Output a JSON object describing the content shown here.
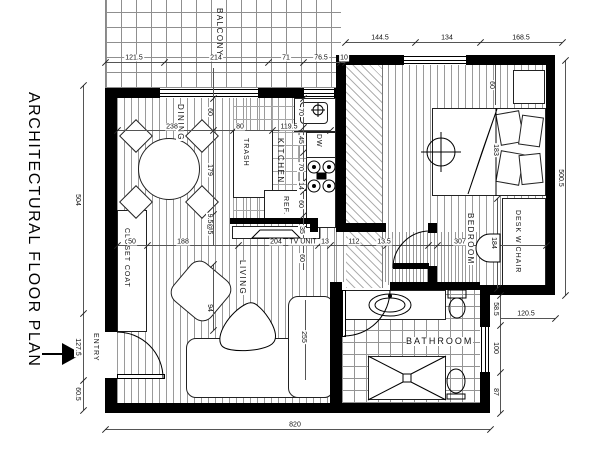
{
  "title": "ARCHITECTURAL FLOOR PLAN",
  "entry": {
    "label": "ENTRY"
  },
  "rooms": {
    "balcony": "BALCONY",
    "dining": "DINING",
    "kitchen": "KITCHEN",
    "living": "LIVING",
    "bedroom": "BEDROOM",
    "bathroom": "BATHROOM"
  },
  "fixtures": {
    "trash": "TRASH",
    "ref": "REF.",
    "dw": "DW",
    "tv_unit": "TV UNIT",
    "closet_coat": "CLOSET COAT",
    "desk_w_chair": "DESK W CHAIR"
  },
  "dimensions": {
    "balcony_top": [
      "121.5",
      "214",
      "71",
      "76.5",
      "10"
    ],
    "bedroom_top": [
      "144.5",
      "134",
      "168.5"
    ],
    "left_side": [
      "504",
      "127.5",
      "60.5"
    ],
    "right_side": [
      "500.5"
    ],
    "right_inner": [
      "58.5",
      "120.5",
      "100",
      "87"
    ],
    "bottom": [
      "820"
    ],
    "dining_row": [
      "238",
      "80",
      "119.5"
    ],
    "dining_col": [
      "60",
      "179",
      "9.5@5",
      "94"
    ],
    "kitchen_col": [
      "70",
      "45",
      "70",
      "14",
      "60",
      "35",
      "60"
    ],
    "hall_row": [
      "50",
      "188",
      "204",
      "13",
      "112",
      "13.5",
      "307"
    ],
    "bed": [
      "60",
      "183",
      "184"
    ],
    "living_col": [
      "255"
    ]
  },
  "colors": {
    "wall": "#000000",
    "hatch": "#9a9a9a",
    "text": "#111111"
  }
}
